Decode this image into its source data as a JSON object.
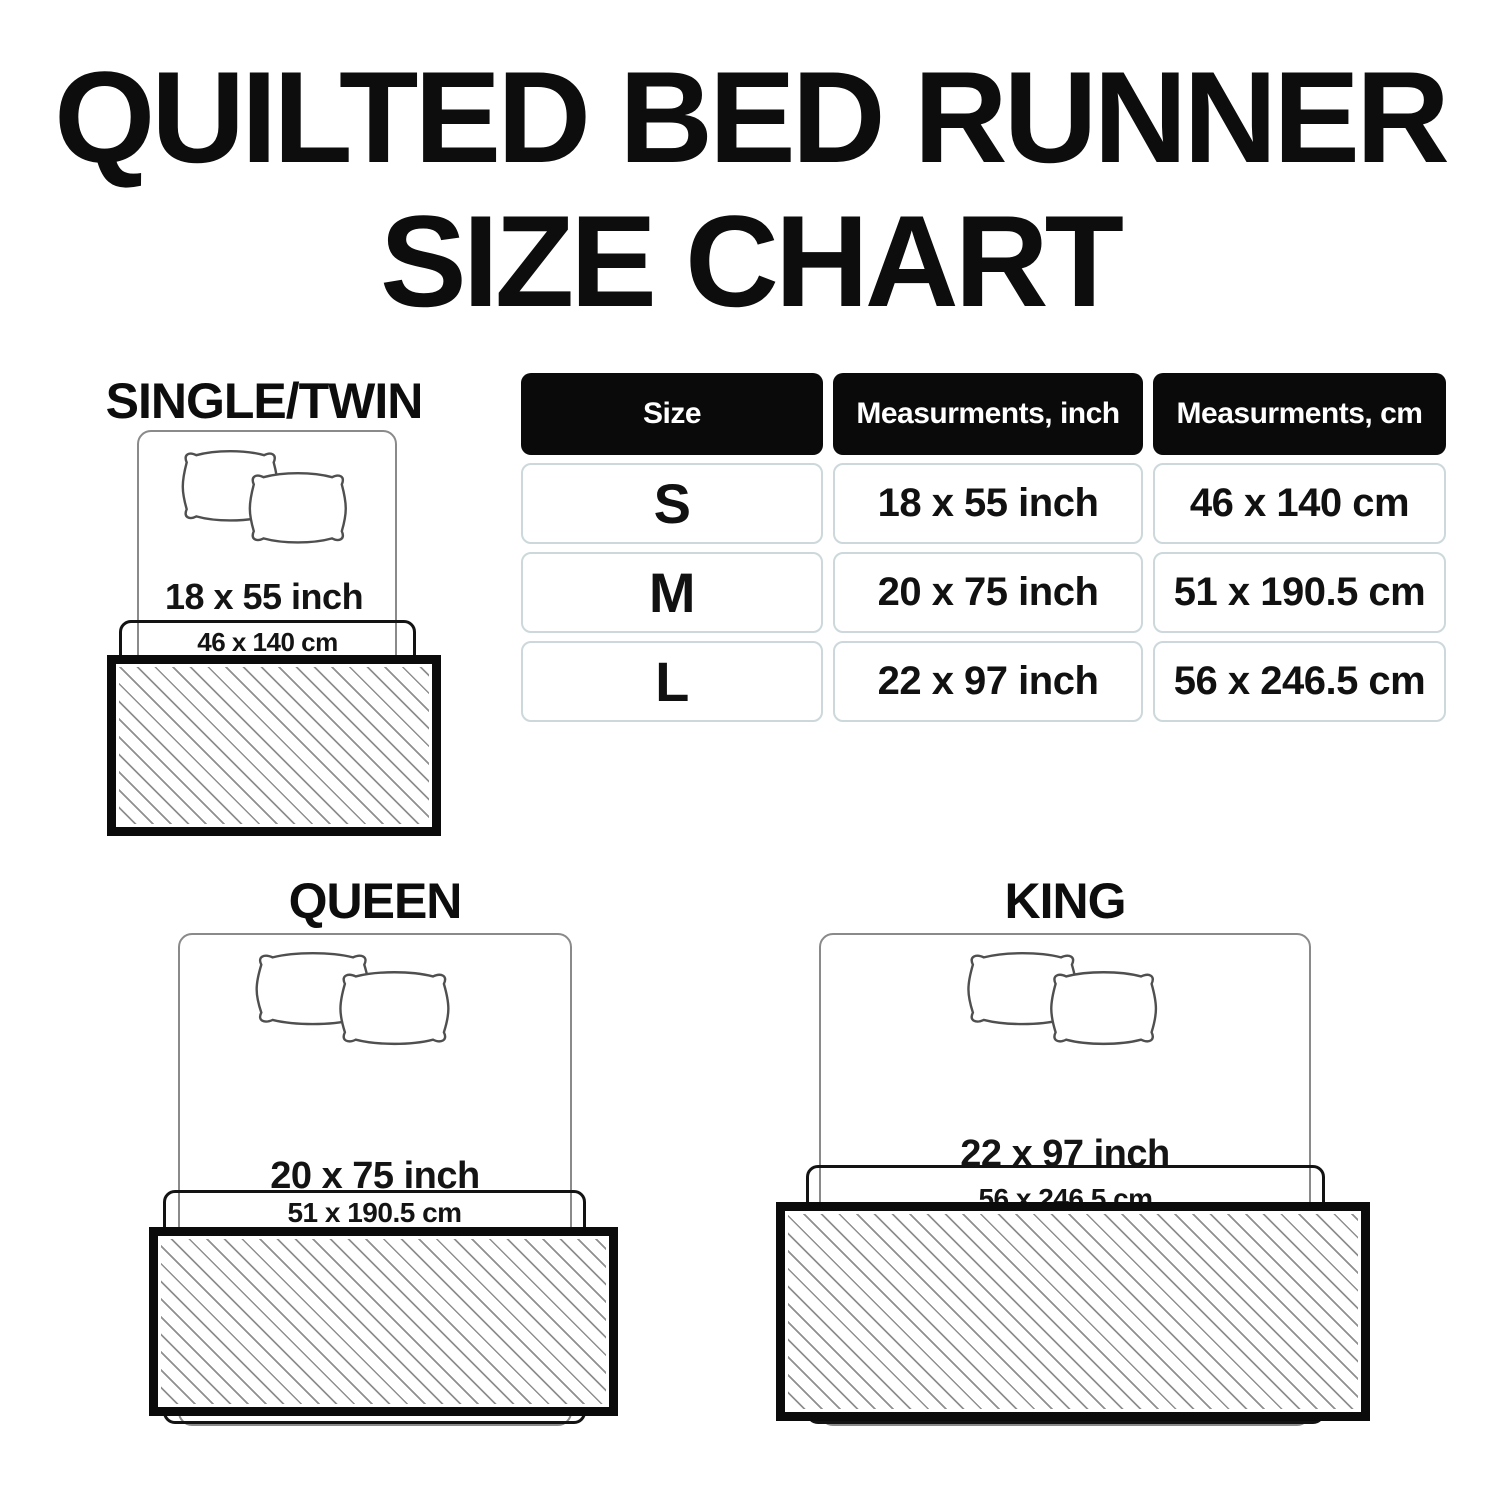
{
  "title": {
    "line1": "QUILTED BED RUNNER",
    "line2": "SIZE CHART"
  },
  "table": {
    "headers": {
      "size": "Size",
      "inch": "Measurments, inch",
      "cm": "Measurments, cm"
    },
    "rows": [
      {
        "size": "S",
        "inch": "18 x 55 inch",
        "cm": "46 x 140 cm"
      },
      {
        "size": "M",
        "inch": "20 x 75 inch",
        "cm": "51 x 190.5 cm"
      },
      {
        "size": "L",
        "inch": "22 x 97 inch",
        "cm": "56 x 246.5 cm"
      }
    ]
  },
  "diagrams": {
    "single": {
      "label": "SINGLE/TWIN",
      "inch": "18 x 55 inch",
      "cm": "46 x 140 cm"
    },
    "queen": {
      "label": "QUEEN",
      "inch": "20 x 75 inch",
      "cm": "51 x 190.5 cm"
    },
    "king": {
      "label": "KING",
      "inch": "22 x 97 inch",
      "cm": "56 x 246.5 cm"
    }
  },
  "colors": {
    "text": "#0d0d0d",
    "header_bg": "#0a0a0a",
    "header_text": "#ffffff",
    "cell_border": "#ccd8db",
    "bed_outline": "#8a8a8a",
    "extent_outline": "#131313",
    "runner_border": "#0b0b0b",
    "hatch_line": "#8f8f8f"
  }
}
